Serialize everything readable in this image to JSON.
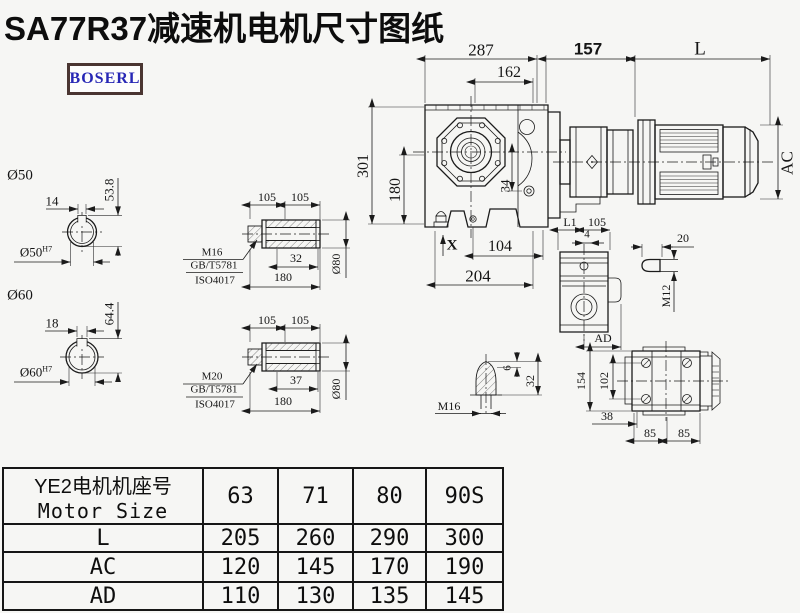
{
  "title": "SA77R37减速机电机尺寸图纸",
  "logo": "BOSERL",
  "colors": {
    "line": "#1b1b1b",
    "background": "#f6f6f4",
    "logo_text": "#2727b5",
    "logo_border": "#4a3531"
  },
  "main_view": {
    "overall_width": "287",
    "flange_width": "162",
    "adapter_length": "157",
    "motor_length": "L",
    "motor_diameter": "AC",
    "overall_height": "301",
    "center_height": "180",
    "offset": "34",
    "marker": "X",
    "foot_inner": "104",
    "foot_width": "204"
  },
  "shaft50": {
    "label": "Ø50",
    "key_width": "14",
    "key_height": "53.8",
    "bore": "Ø50",
    "tolerance": "H7"
  },
  "shaft60": {
    "label": "Ø60",
    "key_width": "18",
    "key_height": "64.4",
    "bore": "Ø60",
    "tolerance": "H7"
  },
  "sleeve_top": {
    "half_a": "105",
    "half_b": "105",
    "thread_len": "32",
    "length": "180",
    "diameter": "Ø80",
    "bolt": "M16",
    "standard1": "GB/T5781",
    "standard2": "ISO4017"
  },
  "sleeve_bottom": {
    "half_a": "105",
    "half_b": "105",
    "thread_len": "37",
    "length": "180",
    "diameter": "Ø80",
    "bolt": "M20",
    "standard1": "GB/T5781",
    "standard2": "ISO4017"
  },
  "side_view": {
    "l1": "L1",
    "width": "105",
    "offset": "4",
    "ad": "AD"
  },
  "key_detail": {
    "length": "20",
    "thread": "M12"
  },
  "plug_detail": {
    "tip": "6",
    "height": "32",
    "thread": "M16"
  },
  "rear_view": {
    "height": "154",
    "bolt_spacing_v": "102",
    "offset": "38",
    "bolt_a": "85",
    "bolt_b": "85"
  },
  "table": {
    "header_cn": "YE2电机机座号",
    "header_en": "Motor Size",
    "columns": [
      "63",
      "71",
      "80",
      "90S"
    ],
    "rows": [
      {
        "label": "L",
        "values": [
          "205",
          "260",
          "290",
          "300"
        ]
      },
      {
        "label": "AC",
        "values": [
          "120",
          "145",
          "170",
          "190"
        ]
      },
      {
        "label": "AD",
        "values": [
          "110",
          "130",
          "135",
          "145"
        ]
      }
    ]
  }
}
